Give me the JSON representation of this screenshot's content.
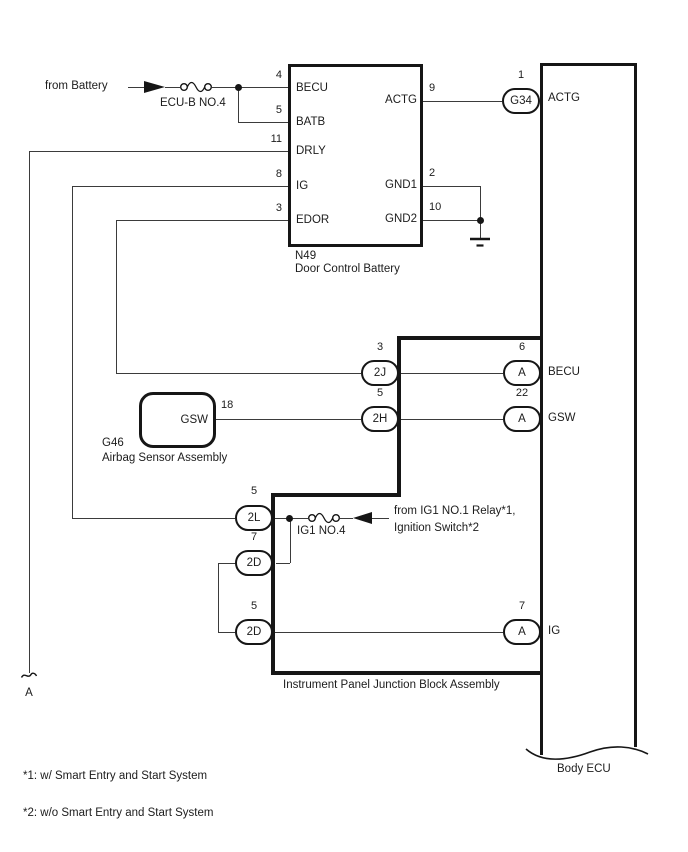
{
  "colors": {
    "background": "#ffffff",
    "line": "#3b3b3b",
    "border": "#161616"
  },
  "battery_feed": {
    "label": "from Battery",
    "fuse_label": "ECU-B NO.4"
  },
  "n49": {
    "code": "N49",
    "name": "Door Control Battery",
    "pins_left": [
      {
        "num": "4",
        "name": "BECU"
      },
      {
        "num": "5",
        "name": "BATB"
      },
      {
        "num": "11",
        "name": "DRLY"
      },
      {
        "num": "8",
        "name": "IG"
      },
      {
        "num": "3",
        "name": "EDOR"
      }
    ],
    "pins_right": [
      {
        "num": "9",
        "name": "ACTG"
      },
      {
        "num": "2",
        "name": "GND1"
      },
      {
        "num": "10",
        "name": "GND2"
      }
    ]
  },
  "g46": {
    "code": "G46",
    "name": "Airbag Sensor Assembly",
    "pin_num": "18",
    "pin_name": "GSW"
  },
  "junction_block": {
    "name": "Instrument Panel Junction Block Assembly",
    "fuse_label": "IG1 NO.4",
    "connectors": [
      {
        "num": "3",
        "label": "2J"
      },
      {
        "num": "5",
        "label": "2H"
      },
      {
        "num": "5",
        "label": "2L"
      },
      {
        "num": "7",
        "label": "2D"
      },
      {
        "num": "5",
        "label": "2D"
      }
    ]
  },
  "ig1_feed": {
    "line1": "from IG1 NO.1 Relay*1,",
    "line2": "Ignition Switch*2"
  },
  "body_ecu": {
    "name": "Body ECU",
    "connectors": [
      {
        "num": "1",
        "label": "G34",
        "pin": "ACTG"
      },
      {
        "num": "6",
        "label": "A",
        "pin": "BECU"
      },
      {
        "num": "22",
        "label": "A",
        "pin": "GSW"
      },
      {
        "num": "7",
        "label": "A",
        "pin": "IG"
      }
    ]
  },
  "continuation": {
    "label": "A"
  },
  "footnotes": [
    "*1: w/ Smart Entry and Start System",
    "*2: w/o Smart Entry and Start System"
  ]
}
